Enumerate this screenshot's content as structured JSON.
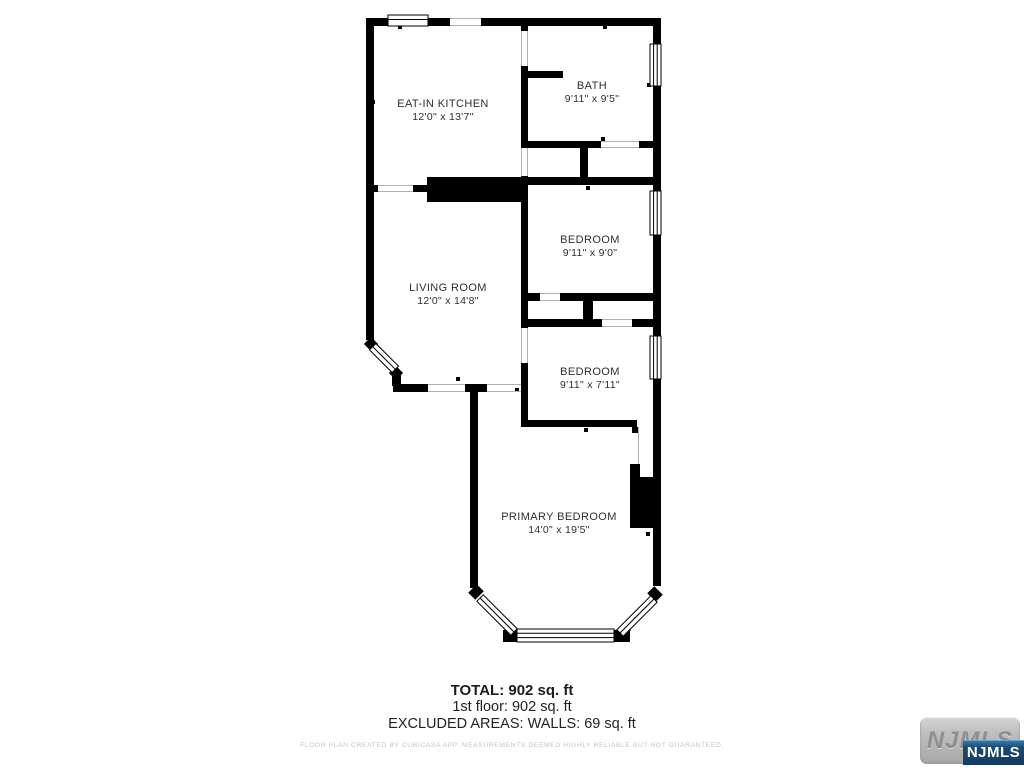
{
  "floor_plan": {
    "rooms": [
      {
        "name": "EAT-IN KITCHEN",
        "dims": "12'0\" x 13'7\""
      },
      {
        "name": "BATH",
        "dims": "9'11\" x 9'5\""
      },
      {
        "name": "BEDROOM",
        "dims": "9'11\" x 9'0\""
      },
      {
        "name": "LIVING ROOM",
        "dims": "12'0\" x 14'8\""
      },
      {
        "name": "BEDROOM",
        "dims": "9'11\" x 7'11\""
      },
      {
        "name": "PRIMARY BEDROOM",
        "dims": "14'0\" x 19'5\""
      }
    ],
    "summary": {
      "total": "TOTAL: 902 sq. ft",
      "floor": "1st floor: 902 sq. ft",
      "excluded": "EXCLUDED AREAS: WALLS: 69 sq. ft"
    },
    "disclaimer": "FLOOR PLAN CREATED BY CUBICASA APP. MEASUREMENTS DEEMED HIGHLY RELIABLE BUT NOT GUARANTEED.",
    "watermark": {
      "background_label": "NJMLS",
      "overlay_label": "NJMLS"
    }
  },
  "colors": {
    "wall": "#000000",
    "background": "#ffffff",
    "label_text": "#2e2e2e",
    "disclaimer_text": "#c6c2c2",
    "watermark_blue": "#1c4a74",
    "watermark_gray": "#b5b5b5"
  }
}
